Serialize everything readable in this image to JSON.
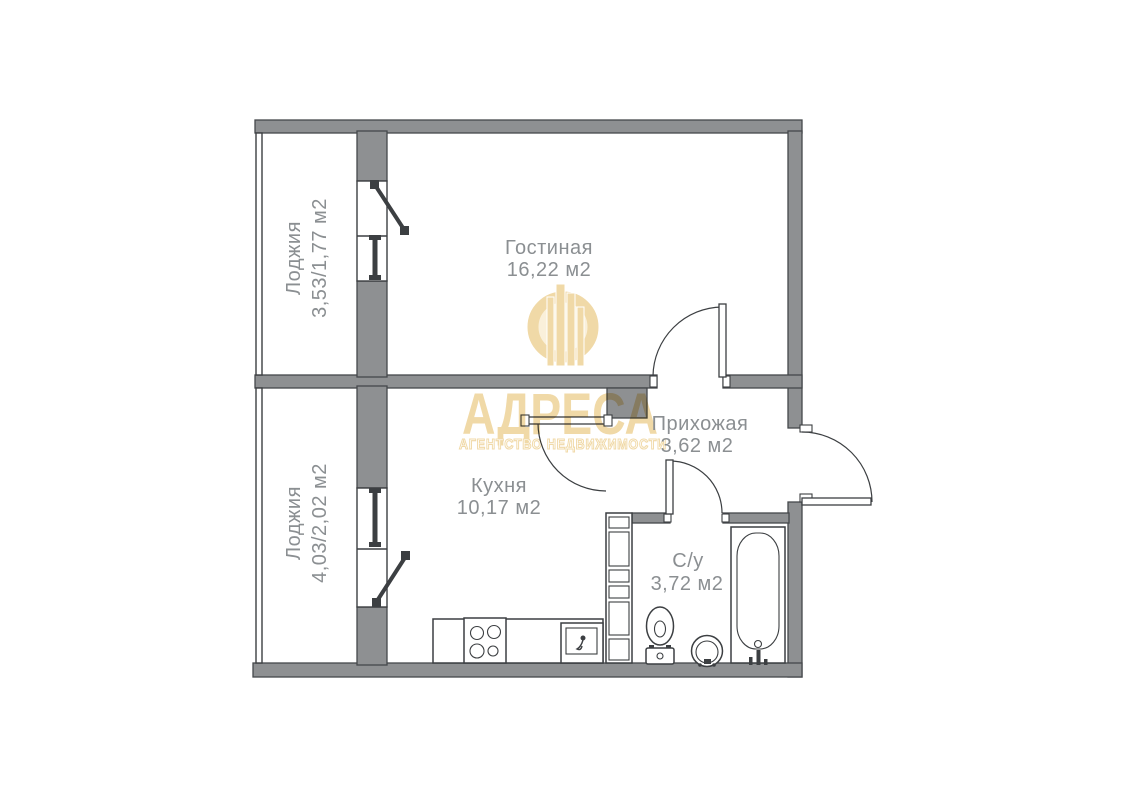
{
  "plan_title": "floor-plan",
  "rooms": {
    "living": {
      "name": "Гостиная",
      "area": "16,22 м2"
    },
    "kitchen": {
      "name": "Кухня",
      "area": "10,17 м2"
    },
    "hallway": {
      "name": "Прихожая",
      "area": "3,62 м2"
    },
    "bathroom": {
      "name": "С/у",
      "area": "3,72 м2"
    },
    "loggia_top": {
      "name": "Лоджия",
      "area": "3,53/1,77 м2"
    },
    "loggia_bottom": {
      "name": "Лоджия",
      "area": "4,03/2,02 м2"
    }
  },
  "watermark": {
    "title": "АДРЕСА",
    "subtitle": "АГЕНТСТВО НЕДВИЖИМОСТИ"
  },
  "colors": {
    "wall": "#8e9092",
    "outline": "#45484b",
    "line": "#3c3f42",
    "label_text": "#8b8f92",
    "watermark_gold": "#f0d7a2",
    "watermark_gold_light": "#faf0d8",
    "background": "#ffffff"
  }
}
